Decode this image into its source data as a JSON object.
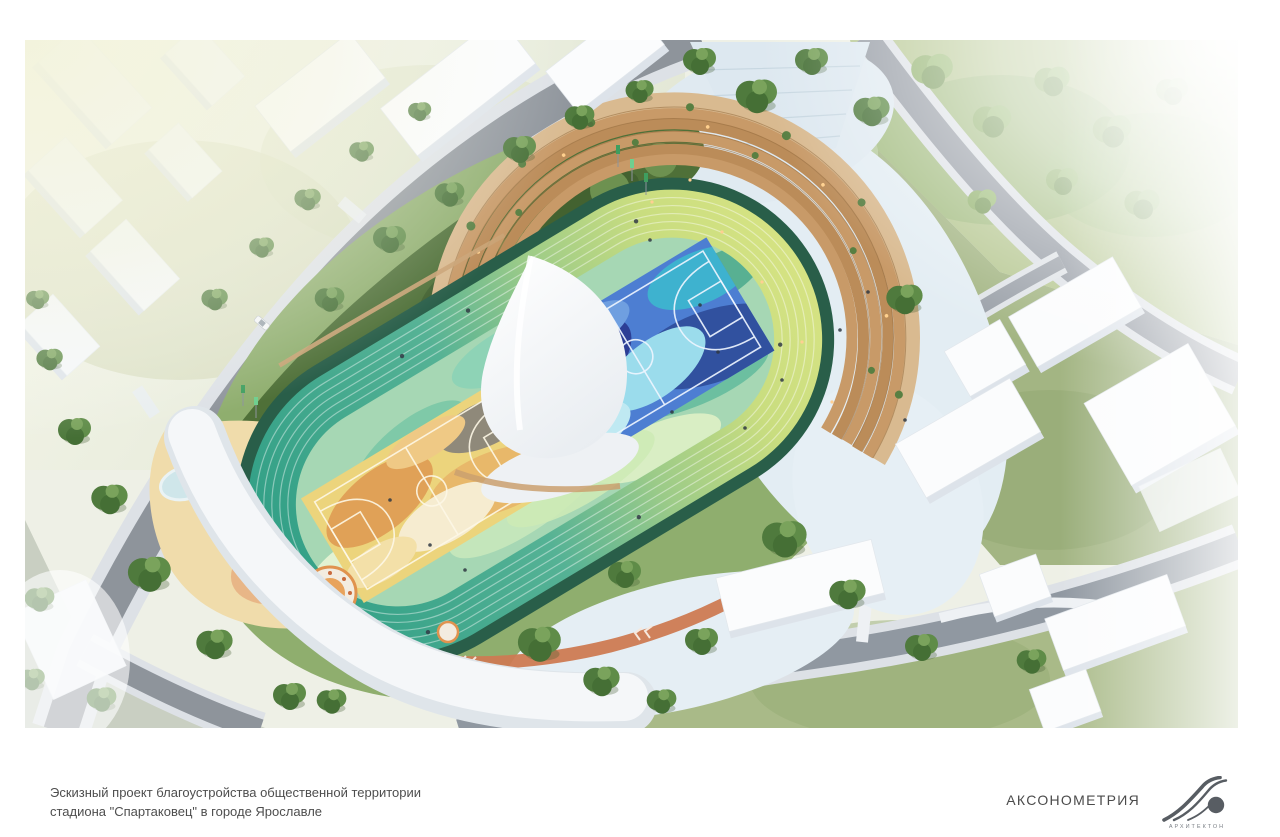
{
  "caption": {
    "line1": "Эскизный проект благоустройства общественной территории",
    "line2": "стадиона \"Спартаковец\" в городе Ярославле"
  },
  "footer": {
    "view_label": "АКСОНОМЕТРИЯ",
    "logo_text": "АРХИТЕКТОН"
  },
  "palette": {
    "track_teal": "#2f9e85",
    "track_lime": "#d6e383",
    "track_edge_green": "#295e49",
    "court_blue": "#4d7ed2",
    "court_navy": "#2c3e95",
    "court_cyan": "#9bdcec",
    "court_yellow": "#ecd47c",
    "court_orange": "#e0a157",
    "amphitheater_wood": "#c89a68",
    "canopy_white": "#f5f7f9",
    "plaza_paving": "#e3edf3",
    "sand": "#f0dcab",
    "road_gray": "#8e949b",
    "lawn_green": "#8fae6e",
    "tree_green": "#4f7a3d",
    "caption_text": "#4e4e4e",
    "logo_gray": "#585d63"
  }
}
